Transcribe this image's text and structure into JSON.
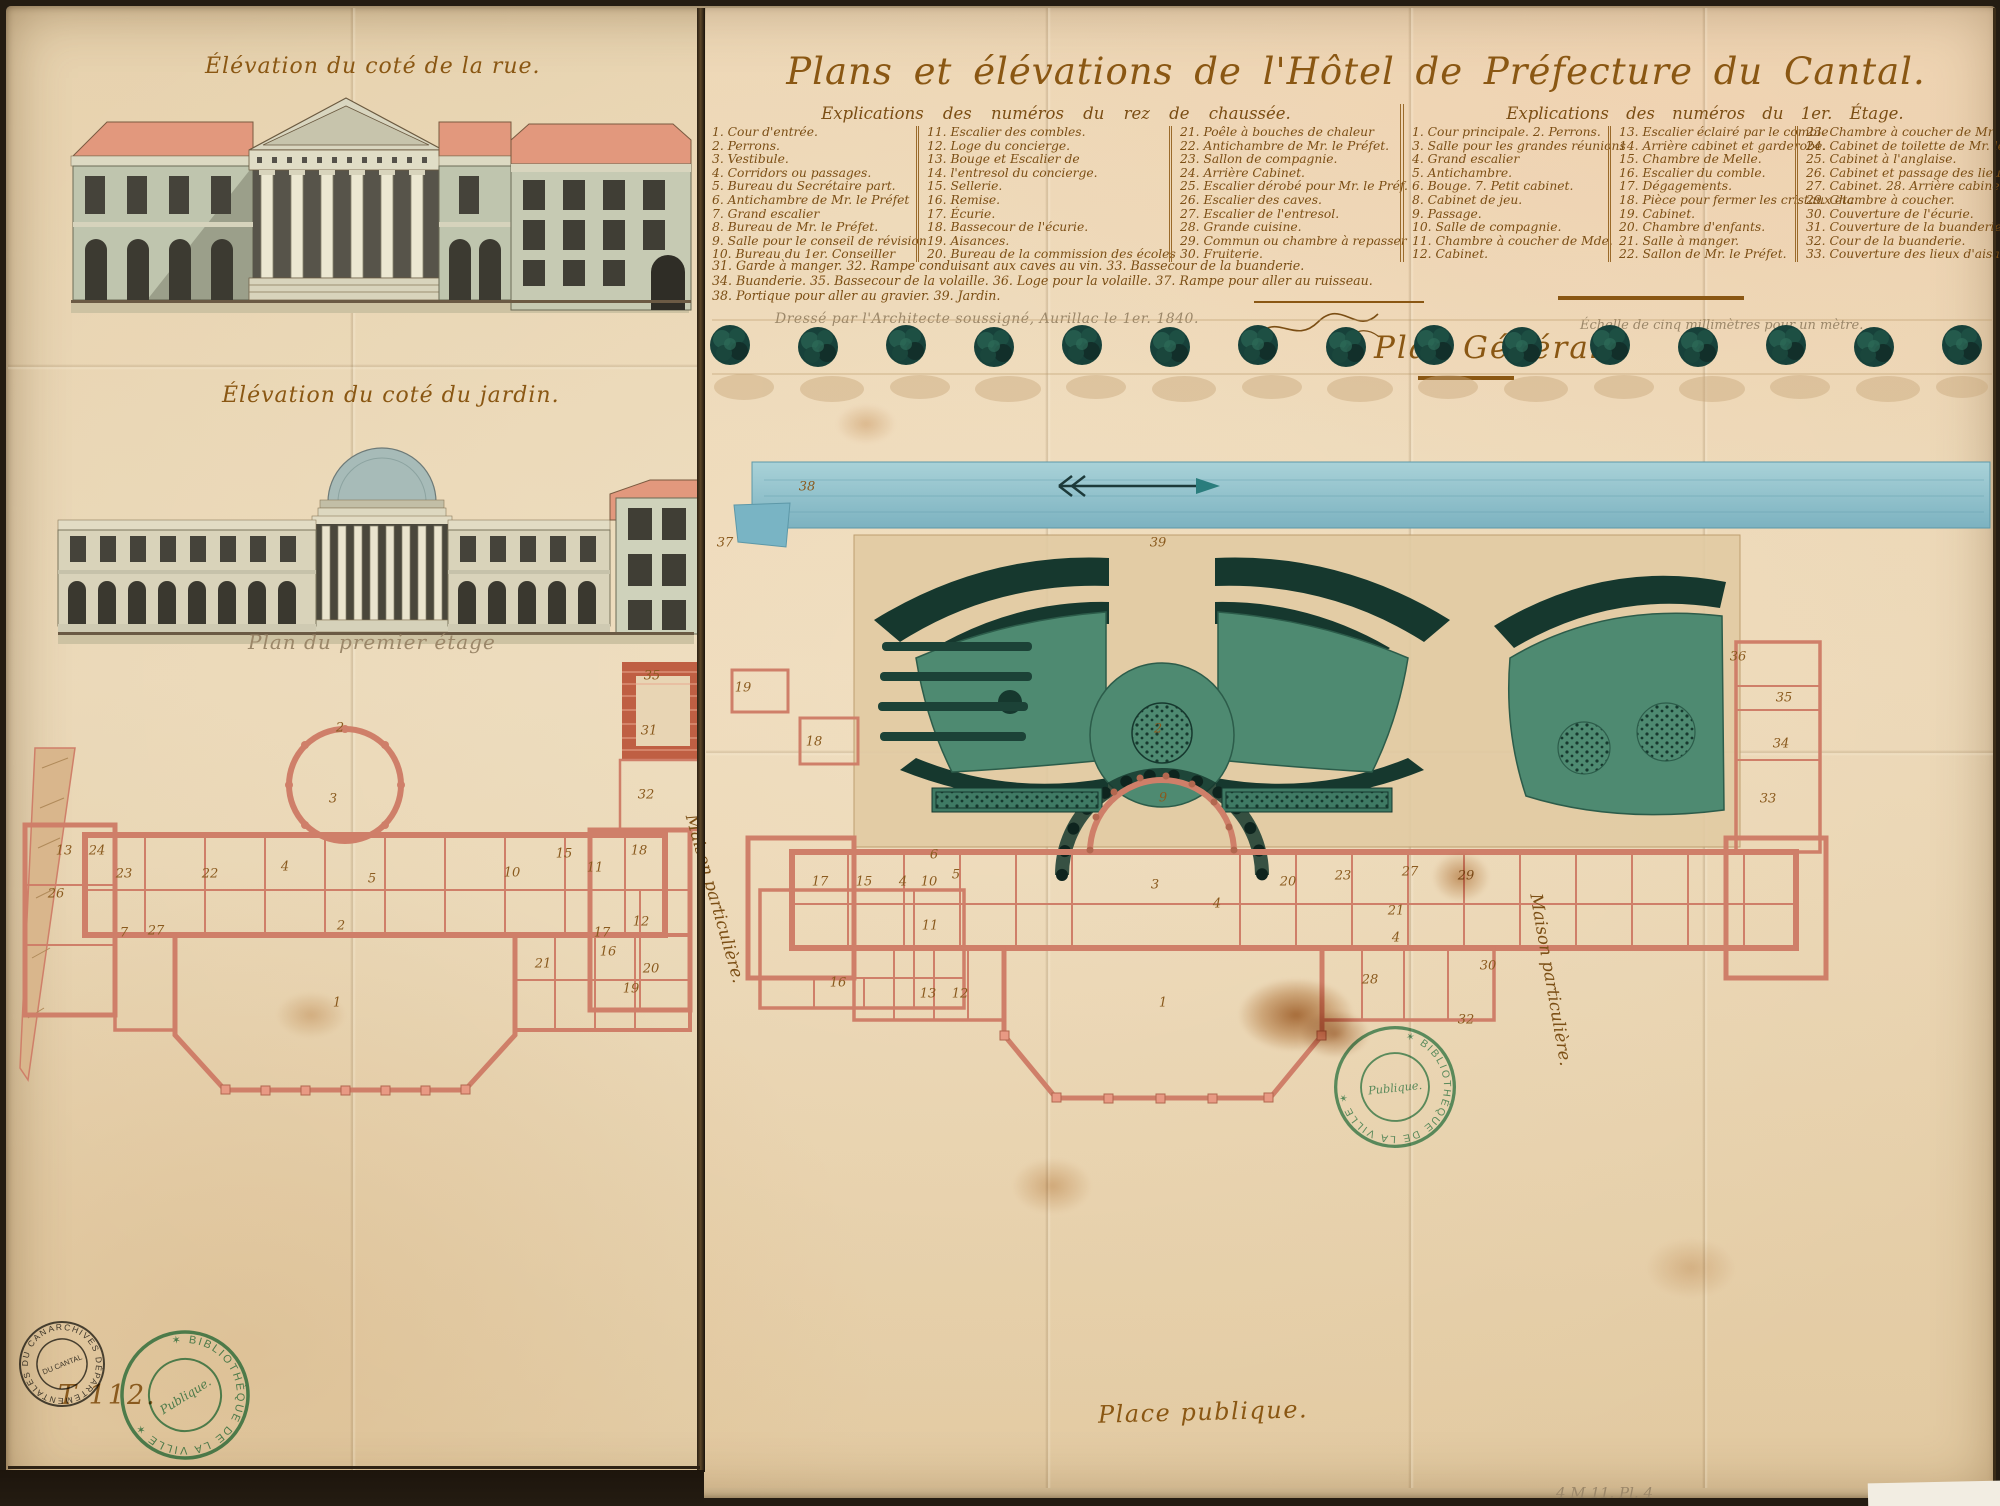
{
  "colors": {
    "paper": "#e8d5b4",
    "ink": "#7b4e14",
    "ink_title": "#8a5713",
    "pencil": "#9b8769",
    "roof_salmon": "#e2987d",
    "wall_green": "#bfc5ae",
    "window_dark": "#423f34",
    "dome_grey": "#a7bbb8",
    "plan_pink": "#cf7f69",
    "lawn_green": "#4e8a71",
    "hedge_dark": "#16382e",
    "tree_teal": "#17413a",
    "water_blue": "#8fc3cf",
    "stamp_green": "#3a8f63",
    "stain_brown": "#a85c10"
  },
  "left_panel": {
    "elevation_street_title": "Élévation du coté de la rue.",
    "elevation_garden_title": "Élévation du coté du jardin.",
    "first_floor_plan_title": "Plan du premier étage",
    "shelfmark": "T 112.",
    "plan_numbers": [
      {
        "n": "35",
        "x": 652,
        "y": 676
      },
      {
        "n": "31",
        "x": 649,
        "y": 731
      },
      {
        "n": "32",
        "x": 646,
        "y": 795
      },
      {
        "n": "2",
        "x": 340,
        "y": 728
      },
      {
        "n": "3",
        "x": 333,
        "y": 799
      },
      {
        "n": "13",
        "x": 64,
        "y": 851
      },
      {
        "n": "24",
        "x": 97,
        "y": 851
      },
      {
        "n": "23",
        "x": 124,
        "y": 874
      },
      {
        "n": "26",
        "x": 56,
        "y": 894
      },
      {
        "n": "22",
        "x": 210,
        "y": 874
      },
      {
        "n": "4",
        "x": 285,
        "y": 867
      },
      {
        "n": "5",
        "x": 372,
        "y": 879
      },
      {
        "n": "10",
        "x": 512,
        "y": 873
      },
      {
        "n": "15",
        "x": 564,
        "y": 854
      },
      {
        "n": "11",
        "x": 595,
        "y": 868
      },
      {
        "n": "18",
        "x": 639,
        "y": 851
      },
      {
        "n": "7",
        "x": 124,
        "y": 933
      },
      {
        "n": "27",
        "x": 156,
        "y": 931
      },
      {
        "n": "2",
        "x": 341,
        "y": 926
      },
      {
        "n": "21",
        "x": 543,
        "y": 964
      },
      {
        "n": "17",
        "x": 602,
        "y": 933
      },
      {
        "n": "16",
        "x": 608,
        "y": 952
      },
      {
        "n": "12",
        "x": 641,
        "y": 922
      },
      {
        "n": "20",
        "x": 651,
        "y": 969
      },
      {
        "n": "19",
        "x": 631,
        "y": 989
      },
      {
        "n": "1",
        "x": 337,
        "y": 1003
      }
    ]
  },
  "right_panel": {
    "main_title": "Plans et élévations de l'Hôtel de Préfecture du Cantal.",
    "legend_ground": {
      "header": "Explications des numéros du rez de chaussée.",
      "col1": [
        "1. Cour d'entrée.",
        "2. Perrons.",
        "3. Vestibule.",
        "4. Corridors ou passages.",
        "5. Bureau du Secrétaire part.",
        "6. Antichambre de Mr. le Préfet",
        "7. Grand escalier",
        "8. Bureau de Mr. le Préfet.",
        "9. Salle pour le conseil de révision",
        "10. Bureau du 1er. Conseiller"
      ],
      "col2": [
        "11. Escalier des combles.",
        "12. Loge du concierge.",
        "13. Bouge et Escalier de",
        "14. l'entresol du concierge.",
        "15. Sellerie.",
        "16. Remise.",
        "17. Écurie.",
        "18. Bassecour de l'écurie.",
        "19. Aisances.",
        "20. Bureau de la commission des écoles"
      ],
      "col3": [
        "21. Poêle à bouches de chaleur",
        "22. Antichambre de Mr. le Préfet.",
        "23. Sallon de compagnie.",
        "24. Arrière Cabinet.",
        "25. Escalier dérobé pour Mr. le Préf.",
        "26. Escalier des caves.",
        "27. Escalier de l'entresol.",
        "28. Grande cuisine.",
        "29. Commun ou chambre à repasser",
        "30. Fruiterie."
      ]
    },
    "legend_first": {
      "header": "Explications des numéros du 1er. Étage.",
      "col1": [
        "1. Cour principale. 2. Perrons.",
        "3. Salle pour les grandes réunions",
        "4. Grand escalier",
        "5. Antichambre.",
        "6. Bouge. 7. Petit cabinet.",
        "8. Cabinet de jeu.",
        "9. Passage.",
        "10. Salle de compagnie.",
        "11. Chambre à coucher de Mde.",
        "12. Cabinet."
      ],
      "col2": [
        "13. Escalier éclairé par le comble",
        "14. Arrière cabinet et garderobe.",
        "15. Chambre de Melle.",
        "16. Escalier du comble.",
        "17. Dégagements.",
        "18. Pièce pour fermer les cristaux etc.",
        "19. Cabinet.",
        "20. Chambre d'enfants.",
        "21. Salle à manger.",
        "22. Sallon de Mr. le Préfet."
      ],
      "col3": [
        "23. Chambre à coucher de Mr. le Préf.",
        "24. Cabinet de toilette de Mr. le Préfet",
        "25. Cabinet à l'anglaise.",
        "26. Cabinet et passage des lieux d'aisance",
        "27. Cabinet. 28. Arrière cabinet.",
        "29. Chambre à coucher.",
        "30. Couverture de l'écurie.",
        "31. Couverture de la buanderie.",
        "32. Cour de la buanderie.",
        "33. Couverture des lieux d'aisance."
      ]
    },
    "legend_footnotes": [
      "31. Garde à manger. 32. Rampe conduisant aux caves au vin. 33. Bassecour de la buanderie.",
      "34. Buanderie. 35. Bassecour de la volaille. 36. Loge pour la volaille. 37. Rampe pour aller au ruisseau.",
      "38. Portique pour aller au gravier. 39. Jardin."
    ],
    "signature_line": "Dressé par l'Architecte soussigné, Aurillac le 1er. 1840.",
    "plan_general_title": "Plan Général.",
    "scale_note": "Échelle de cinq millimètres pour un mètre.",
    "place_label": "Place publique.",
    "house_label_left": "Maison particulière.",
    "house_label_right": "Maison particulière.",
    "corner_note": "4 M 11. Pl. 4",
    "plan_numbers": [
      {
        "n": "38",
        "x": 807,
        "y": 487
      },
      {
        "n": "37",
        "x": 725,
        "y": 543
      },
      {
        "n": "39",
        "x": 1158,
        "y": 543
      },
      {
        "n": "19",
        "x": 743,
        "y": 688
      },
      {
        "n": "18",
        "x": 814,
        "y": 742
      },
      {
        "n": "36",
        "x": 1738,
        "y": 657
      },
      {
        "n": "35",
        "x": 1784,
        "y": 698
      },
      {
        "n": "34",
        "x": 1781,
        "y": 744
      },
      {
        "n": "33",
        "x": 1768,
        "y": 799
      },
      {
        "n": "6",
        "x": 934,
        "y": 855
      },
      {
        "n": "5",
        "x": 956,
        "y": 875
      },
      {
        "n": "17",
        "x": 820,
        "y": 882
      },
      {
        "n": "15",
        "x": 864,
        "y": 882
      },
      {
        "n": "4",
        "x": 903,
        "y": 882
      },
      {
        "n": "10",
        "x": 929,
        "y": 882
      },
      {
        "n": "11",
        "x": 930,
        "y": 926
      },
      {
        "n": "13",
        "x": 928,
        "y": 994
      },
      {
        "n": "12",
        "x": 960,
        "y": 994
      },
      {
        "n": "16",
        "x": 838,
        "y": 983
      },
      {
        "n": "2",
        "x": 1158,
        "y": 729
      },
      {
        "n": "9",
        "x": 1163,
        "y": 798
      },
      {
        "n": "3",
        "x": 1155,
        "y": 885
      },
      {
        "n": "4",
        "x": 1217,
        "y": 904
      },
      {
        "n": "20",
        "x": 1288,
        "y": 882
      },
      {
        "n": "23",
        "x": 1343,
        "y": 876
      },
      {
        "n": "27",
        "x": 1410,
        "y": 872
      },
      {
        "n": "29",
        "x": 1466,
        "y": 876
      },
      {
        "n": "21",
        "x": 1396,
        "y": 911
      },
      {
        "n": "4",
        "x": 1396,
        "y": 938
      },
      {
        "n": "28",
        "x": 1370,
        "y": 980
      },
      {
        "n": "30",
        "x": 1488,
        "y": 966
      },
      {
        "n": "32",
        "x": 1466,
        "y": 1020
      },
      {
        "n": "1",
        "x": 1163,
        "y": 1003
      }
    ]
  },
  "stamps": {
    "archive_ring": "ARCHIVES DÉPARTEMENTALES DU CANTAL ✶",
    "archive_center": "DU CANTAL",
    "library_ring": "✶ BIBLIOTHÈQUE DE LA VILLE ✶",
    "library_center": "Publique."
  }
}
